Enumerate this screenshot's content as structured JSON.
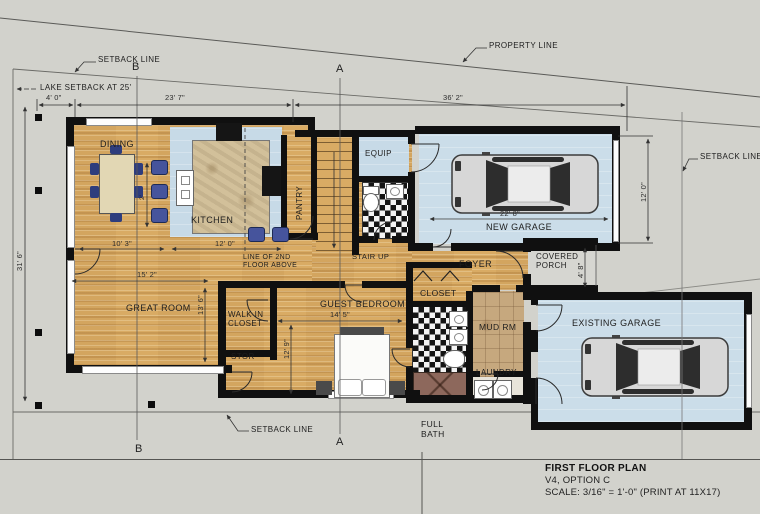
{
  "title_block": {
    "title": "FIRST FLOOR PLAN",
    "subtitle": "V4, OPTION C",
    "scale": "SCALE: 3/16\" = 1'-0\" (PRINT AT 11X17)"
  },
  "site": {
    "property_line": "PROPERTY LINE",
    "setback_top": "SETBACK LINE",
    "setback_right": "SETBACK LINE",
    "setback_bottom": "SETBACK LINE",
    "lake_setback": "LAKE SETBACK AT 25'"
  },
  "sections": {
    "a": "A",
    "b": "B"
  },
  "rooms": {
    "dining": "DINING",
    "kitchen": "KITCHEN",
    "pantry": "PANTRY",
    "equip": "EQUIP",
    "stair": "STAIR UP",
    "foyer": "FOYER",
    "covered_porch": "COVERED PORCH",
    "new_garage": "NEW GARAGE",
    "great_room": "GREAT ROOM",
    "walk_in_closet": "WALK IN CLOSET",
    "stor": "STOR",
    "guest_bedroom": "GUEST BEDROOM",
    "closet": "CLOSET",
    "mud_rm": "MUD RM",
    "laundry": "LAUNDRY",
    "existing_garage": "EXISTING GARAGE",
    "full_bath": "FULL BATH"
  },
  "annotations": {
    "second_floor": "LINE OF 2ND FLOOR ABOVE"
  },
  "dims": {
    "w4_0": "4' 0\"",
    "w23_7": "23' 7\"",
    "w36_2": "36' 2\"",
    "h31_6": "31' 6\"",
    "h12_0": "12' 0\"",
    "w22_8": "22' 8\"",
    "w10_3": "10' 3\"",
    "w12_0": "12' 0\"",
    "w15_2": "15' 2\"",
    "h13_6": "13' 6\"",
    "h12_9": "12' 9\"",
    "w14_5": "14' 5\"",
    "h4_8": "4' 8\"",
    "h2_0": "2'"
  },
  "colors": {
    "site_bg": "#d2d2cc",
    "wall": "#101010",
    "wood_floor": "#d9ab64",
    "tile_blue": "#c7dae7",
    "furniture_blue": "#46549c",
    "checker_dark": "#141414"
  }
}
